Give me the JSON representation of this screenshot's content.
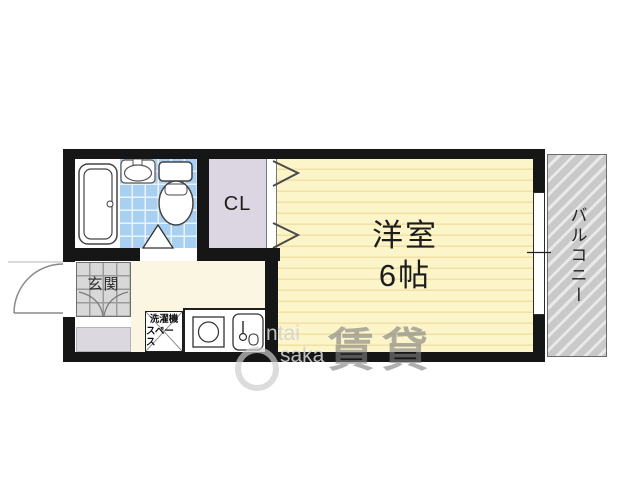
{
  "plan": {
    "rooms": {
      "main_room": {
        "name": "洋室",
        "size": "6帖"
      },
      "closet": {
        "label": "CL"
      },
      "balcony": {
        "label": "バルコニー"
      },
      "entrance": {
        "label": "玄関"
      },
      "laundry_space": {
        "line1": "洗濯機",
        "line2": "スペース"
      }
    },
    "watermark": {
      "latin_line1": "ntai",
      "latin_line2": "saka",
      "kanji": "賃貸"
    },
    "colors": {
      "wall": "#161616",
      "main_room_fill": "#fcf5ca",
      "main_room_stripe": "#f1e1a6",
      "kitchen_fill": "#faf6e2",
      "bath_tile_blue": "#a9cff1",
      "closet_fill": "#dbd6e1",
      "entrance_tile": "#d8d8d8",
      "shoe_cabinet_fill": "#dcd8df",
      "balcony_fill": "#c9c9c9"
    }
  }
}
